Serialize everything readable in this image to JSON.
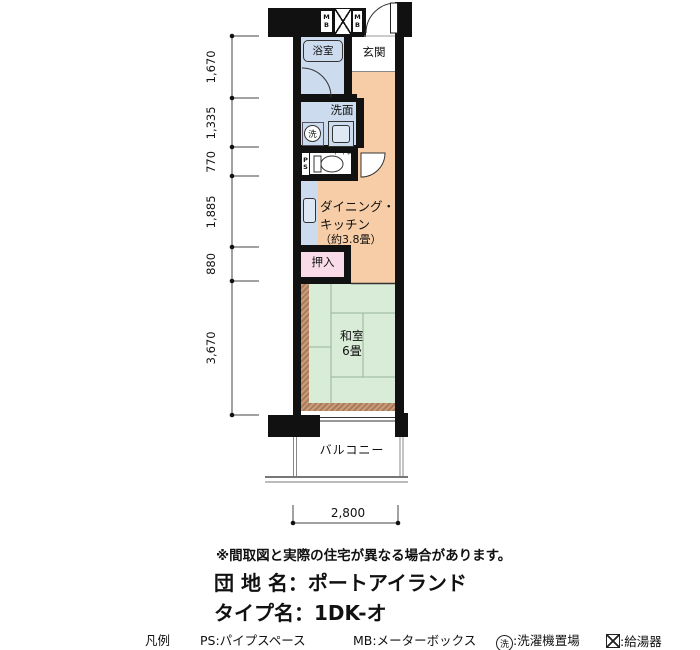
{
  "floorplan": {
    "labels": {
      "bath": "浴室",
      "entrance": "玄関",
      "washroom": "洗面",
      "toilet": "トイレ",
      "washer_symbol": "洗",
      "ps": "PS",
      "mb_left": "MB",
      "mb_right": "MB",
      "dk_line1": "ダイニング・",
      "dk_line2": "キッチン",
      "dk_line3": "（約3.8畳）",
      "closet": "押入",
      "japanese_room_line1": "和室",
      "japanese_room_line2": "6畳",
      "balcony": "バルコニー"
    },
    "dimensions": {
      "left": [
        "1,670",
        "1,335",
        "770",
        "1,885",
        "880",
        "3,670"
      ],
      "bottom": "2,800"
    }
  },
  "footer": {
    "note": "※間取図と実際の住宅が異なる場合があります。",
    "estate_name": "団 地 名：ポートアイランド",
    "type_name": "タイプ名：1DK-オ",
    "legend": {
      "title": "凡例",
      "ps": "PS:パイプスペース",
      "mb": "MB:メーターボックス",
      "washer_symbol": "洗",
      "washer_label": ":洗濯機置場",
      "heater_label": ":給湯器"
    }
  },
  "colors": {
    "wall": "#111111",
    "dining_kitchen": "#f6cda6",
    "wet_area": "#ccdbed",
    "tatami": "#d9ecd8",
    "closet": "#fadce8",
    "engawa": "#aa7b58"
  }
}
